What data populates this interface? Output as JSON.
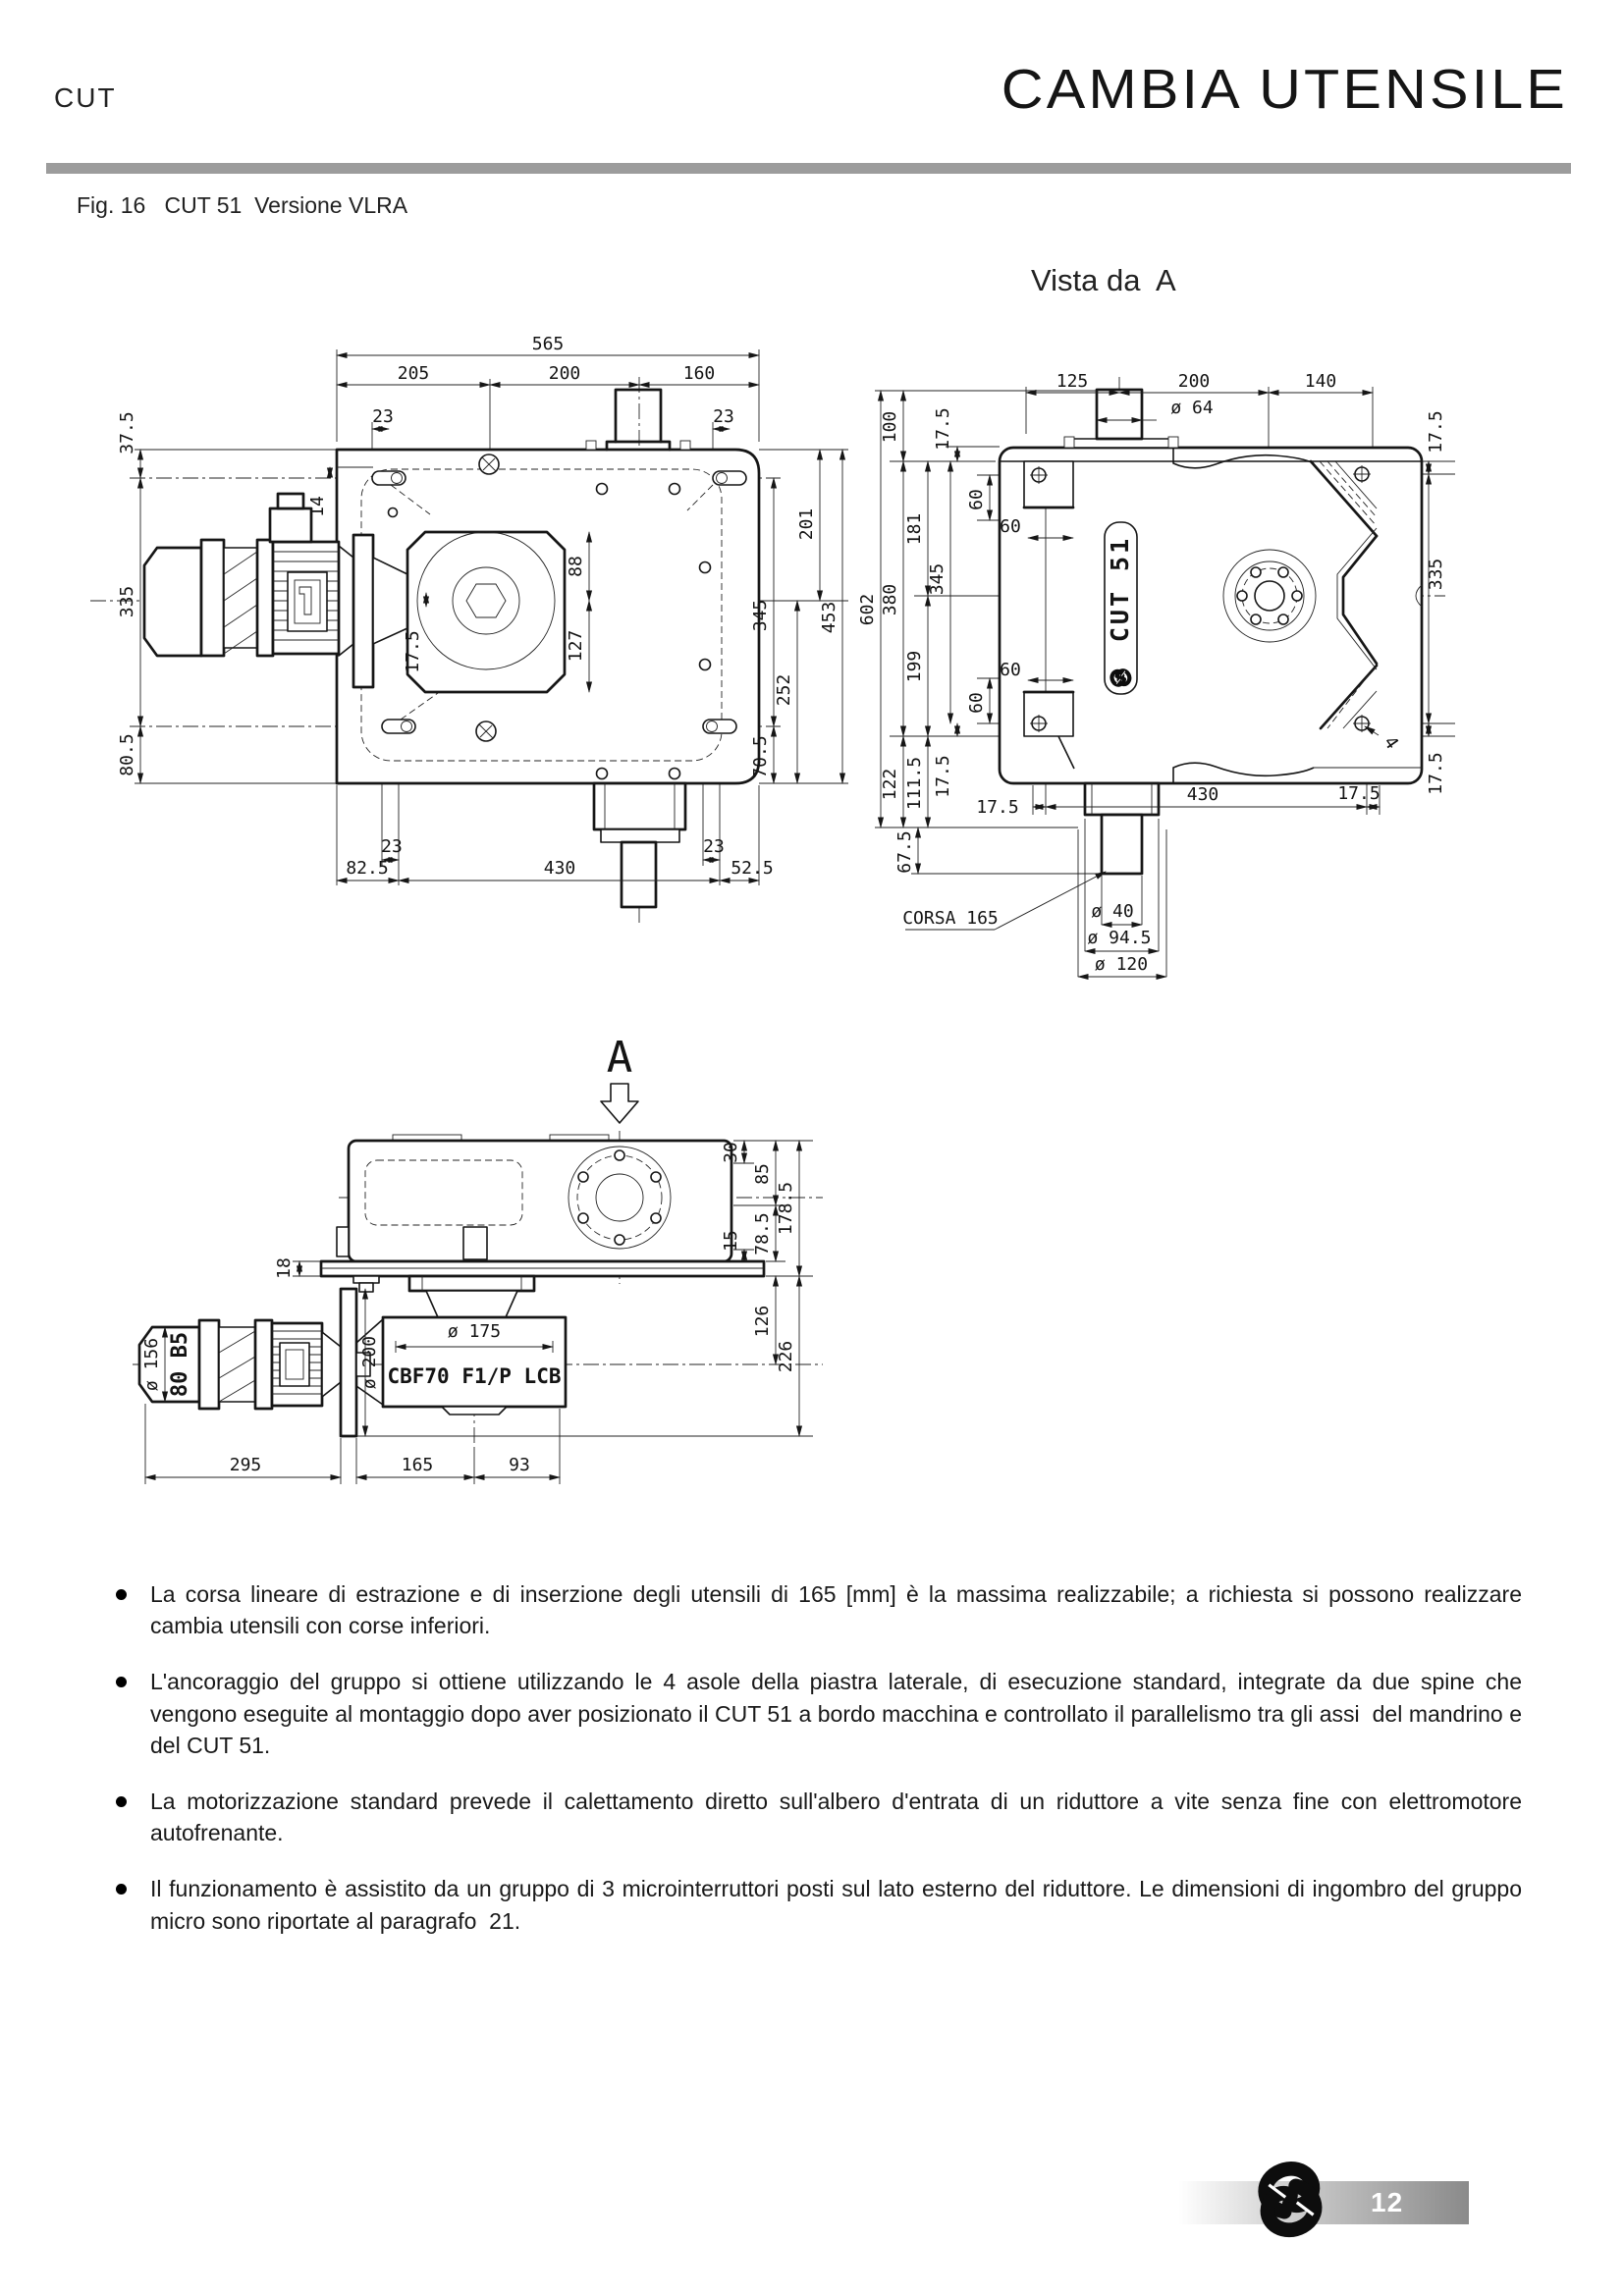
{
  "header": {
    "doc_code": "CUT",
    "title": "CAMBIA UTENSILE"
  },
  "figure": {
    "caption": "Fig. 16   CUT 51  Versione VLRA"
  },
  "front_view": {
    "dims_top": [
      "565",
      "205",
      "200",
      "160",
      "23",
      "23"
    ],
    "dims_left": [
      "37.5",
      "335",
      "80.5",
      "14",
      "17.5"
    ],
    "dims_right": [
      "201",
      "345",
      "453",
      "252",
      "70.5",
      "88",
      "127"
    ],
    "dims_bottom": [
      "23",
      "23",
      "82.5",
      "430",
      "52.5"
    ]
  },
  "side_view": {
    "title": "Vista da  A",
    "body_label": "CUT 51",
    "dims_top": [
      "125",
      "200",
      "140",
      "ø 64"
    ],
    "dims_left": [
      "602",
      "100",
      "380",
      "122",
      "181",
      "199",
      "111.5",
      "345",
      "17.5",
      "17.5",
      "67.5"
    ],
    "dims_inner": [
      "60",
      "60",
      "60",
      "60"
    ],
    "dims_right": [
      "17.5",
      "335",
      "17.5"
    ],
    "dims_bottom": [
      "17.5",
      "430",
      "17.5"
    ],
    "shaft_dims": [
      "ø 40",
      "ø 94.5",
      "ø 120"
    ],
    "corsa_label": "CORSA 165",
    "quantity_label": "4"
  },
  "bottom_view": {
    "view_marker": "A",
    "motor_label": "CBF70 F1/P LCB",
    "dims_left": [
      "18",
      "ø 156",
      "80 B5",
      "ø 200"
    ],
    "dims_mid": [
      "ø 175"
    ],
    "dims_right": [
      "30",
      "85",
      "178.5",
      "78.5",
      "15",
      "126",
      "226"
    ],
    "dims_bottom": [
      "295",
      "165",
      "93"
    ]
  },
  "notes": [
    "La corsa lineare di estrazione e di inserzione degli utensili di 165 [mm] è la massima realizzabile; a richiesta si possono realizzare cambia utensili con corse inferiori.",
    "L'ancoraggio del gruppo si ottiene utilizzando le 4 asole della piastra laterale, di esecuzione standard, integrate da due spine che vengono eseguite al montaggio dopo aver posizionato il CUT 51 a bordo macchina e controllato il parallelismo tra gli assi  del mandrino e del CUT 51.",
    "La motorizzazione standard prevede il calettamento diretto sull'albero d'entrata di un riduttore a vite senza fine con elettromotore autofrenante.",
    "Il funzionamento è assistito da un gruppo di 3 microinterruttori posti sul lato esterno del riduttore. Le dimensioni di ingombro del gruppo micro sono riportate al paragrafo  21."
  ],
  "footer": {
    "page_number": "12"
  }
}
